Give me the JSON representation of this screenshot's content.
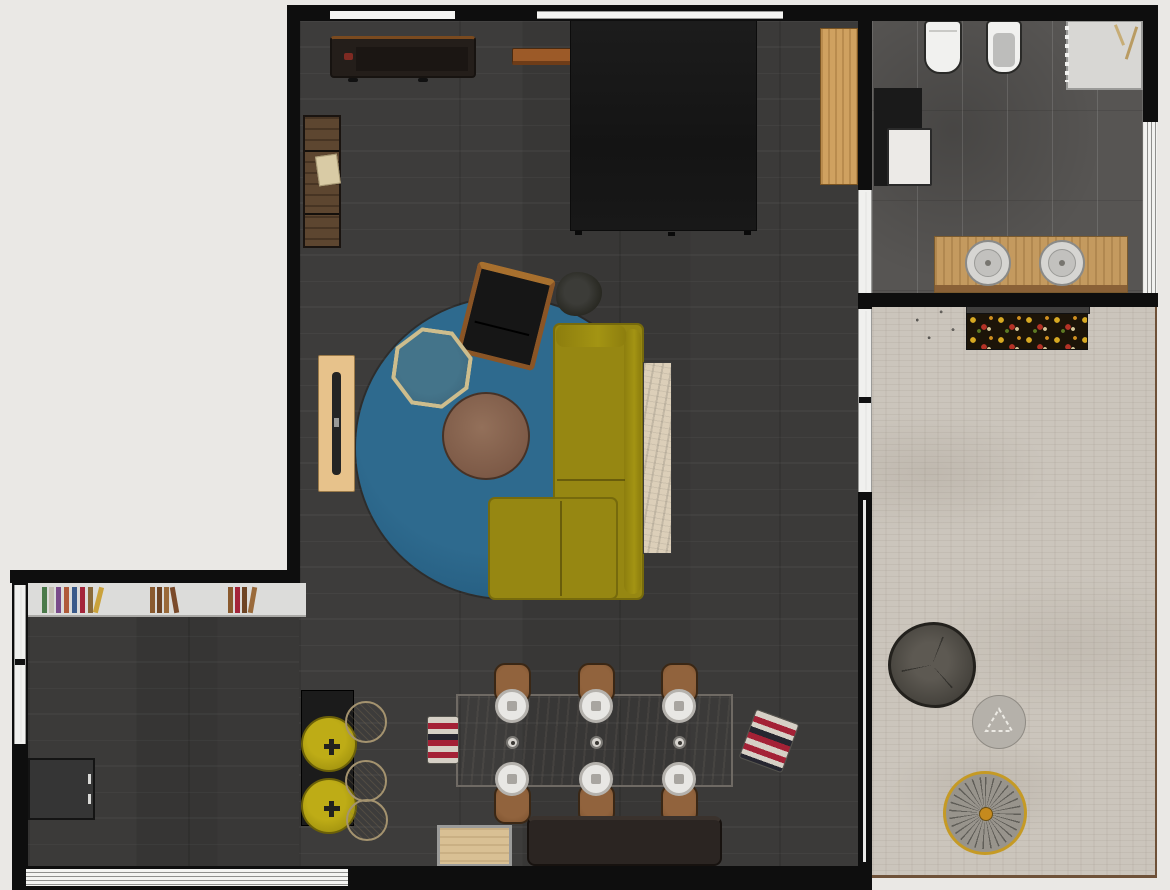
{
  "app": {
    "title": "Apartment floor plan — top-down 2D render",
    "view": "top-down"
  },
  "palette": {
    "background": "#eae8e5",
    "wall": "#0e0e0e",
    "wood_floor_dark": "#3a3938",
    "bathroom_tile": "#575553",
    "bedroom_rug_beige": "#cbc5bc",
    "bedroom_rug_border": "#6e5138",
    "area_rug_blue": "#2b6386",
    "sofa_mustard": "#968712",
    "stool_yellow": "#b5a413",
    "stripe_red": "#a42136",
    "wood_light": "#cfa160",
    "plant_green": "#1e7a1f"
  },
  "rooms": {
    "living": {
      "name": "Living room",
      "floor": "dark wood planks"
    },
    "dining": {
      "name": "Dining area",
      "floor": "dark wood planks"
    },
    "kitchen": {
      "name": "Kitchen nook",
      "floor": "dark wood planks"
    },
    "bathroom": {
      "name": "Bathroom",
      "floor": "gray tile"
    },
    "bedroom": {
      "name": "Bedroom den",
      "floor": "beige area rug"
    }
  },
  "furniture": {
    "media_console": {
      "name": "Media console with TV"
    },
    "wall_shelf": {
      "name": "Wood wall shelf"
    },
    "dark_bed": {
      "name": "Large dark bed"
    },
    "tall_cabinet": {
      "name": "Tall wood cabinet"
    },
    "ladder_shelf": {
      "name": "Rustic wall shelf"
    },
    "blue_rug": {
      "name": "Round blue rug"
    },
    "armchair": {
      "name": "Black armchair"
    },
    "plant_small": {
      "name": "Potted plant"
    },
    "side_table": {
      "name": "Octagonal side table"
    },
    "coffee_table": {
      "name": "Round coffee table"
    },
    "sofa": {
      "name": "Mustard corner sofa"
    },
    "sofa_console": {
      "name": "Marble console table"
    },
    "sideboard": {
      "name": "Wood sideboard"
    },
    "dining_table": {
      "name": "Dining table for six"
    },
    "dining_chair": {
      "name": "Dining chair"
    },
    "plate": {
      "name": "Place setting"
    },
    "candle": {
      "name": "Table candle"
    },
    "pouf_striped_left": {
      "name": "Striped pouf"
    },
    "pouf_striped_right": {
      "name": "Striped pouf"
    },
    "bench_dark": {
      "name": "Dark bench"
    },
    "bench_light": {
      "name": "Wood bench"
    },
    "bookshelf": {
      "name": "Low wall bookshelf"
    },
    "island": {
      "name": "Black bar counter"
    },
    "stool_yellow": {
      "name": "Yellow stool"
    },
    "stool_beige": {
      "name": "Rattan stool"
    },
    "kitchen_block": {
      "name": "Kitchen counter"
    },
    "toilet": {
      "name": "Toilet"
    },
    "bidet": {
      "name": "Bidet"
    },
    "shower": {
      "name": "Shower"
    },
    "washer": {
      "name": "Washing machine"
    },
    "vanity": {
      "name": "Double sink vanity"
    },
    "daybed": {
      "name": "Patterned daybed"
    },
    "plant_bedroom": {
      "name": "Green plant"
    },
    "pouf_dark": {
      "name": "Dark floor pouf"
    },
    "pouf_gray": {
      "name": "Gray floor pouf"
    },
    "wheel_decor": {
      "name": "Round spoke decor"
    }
  }
}
